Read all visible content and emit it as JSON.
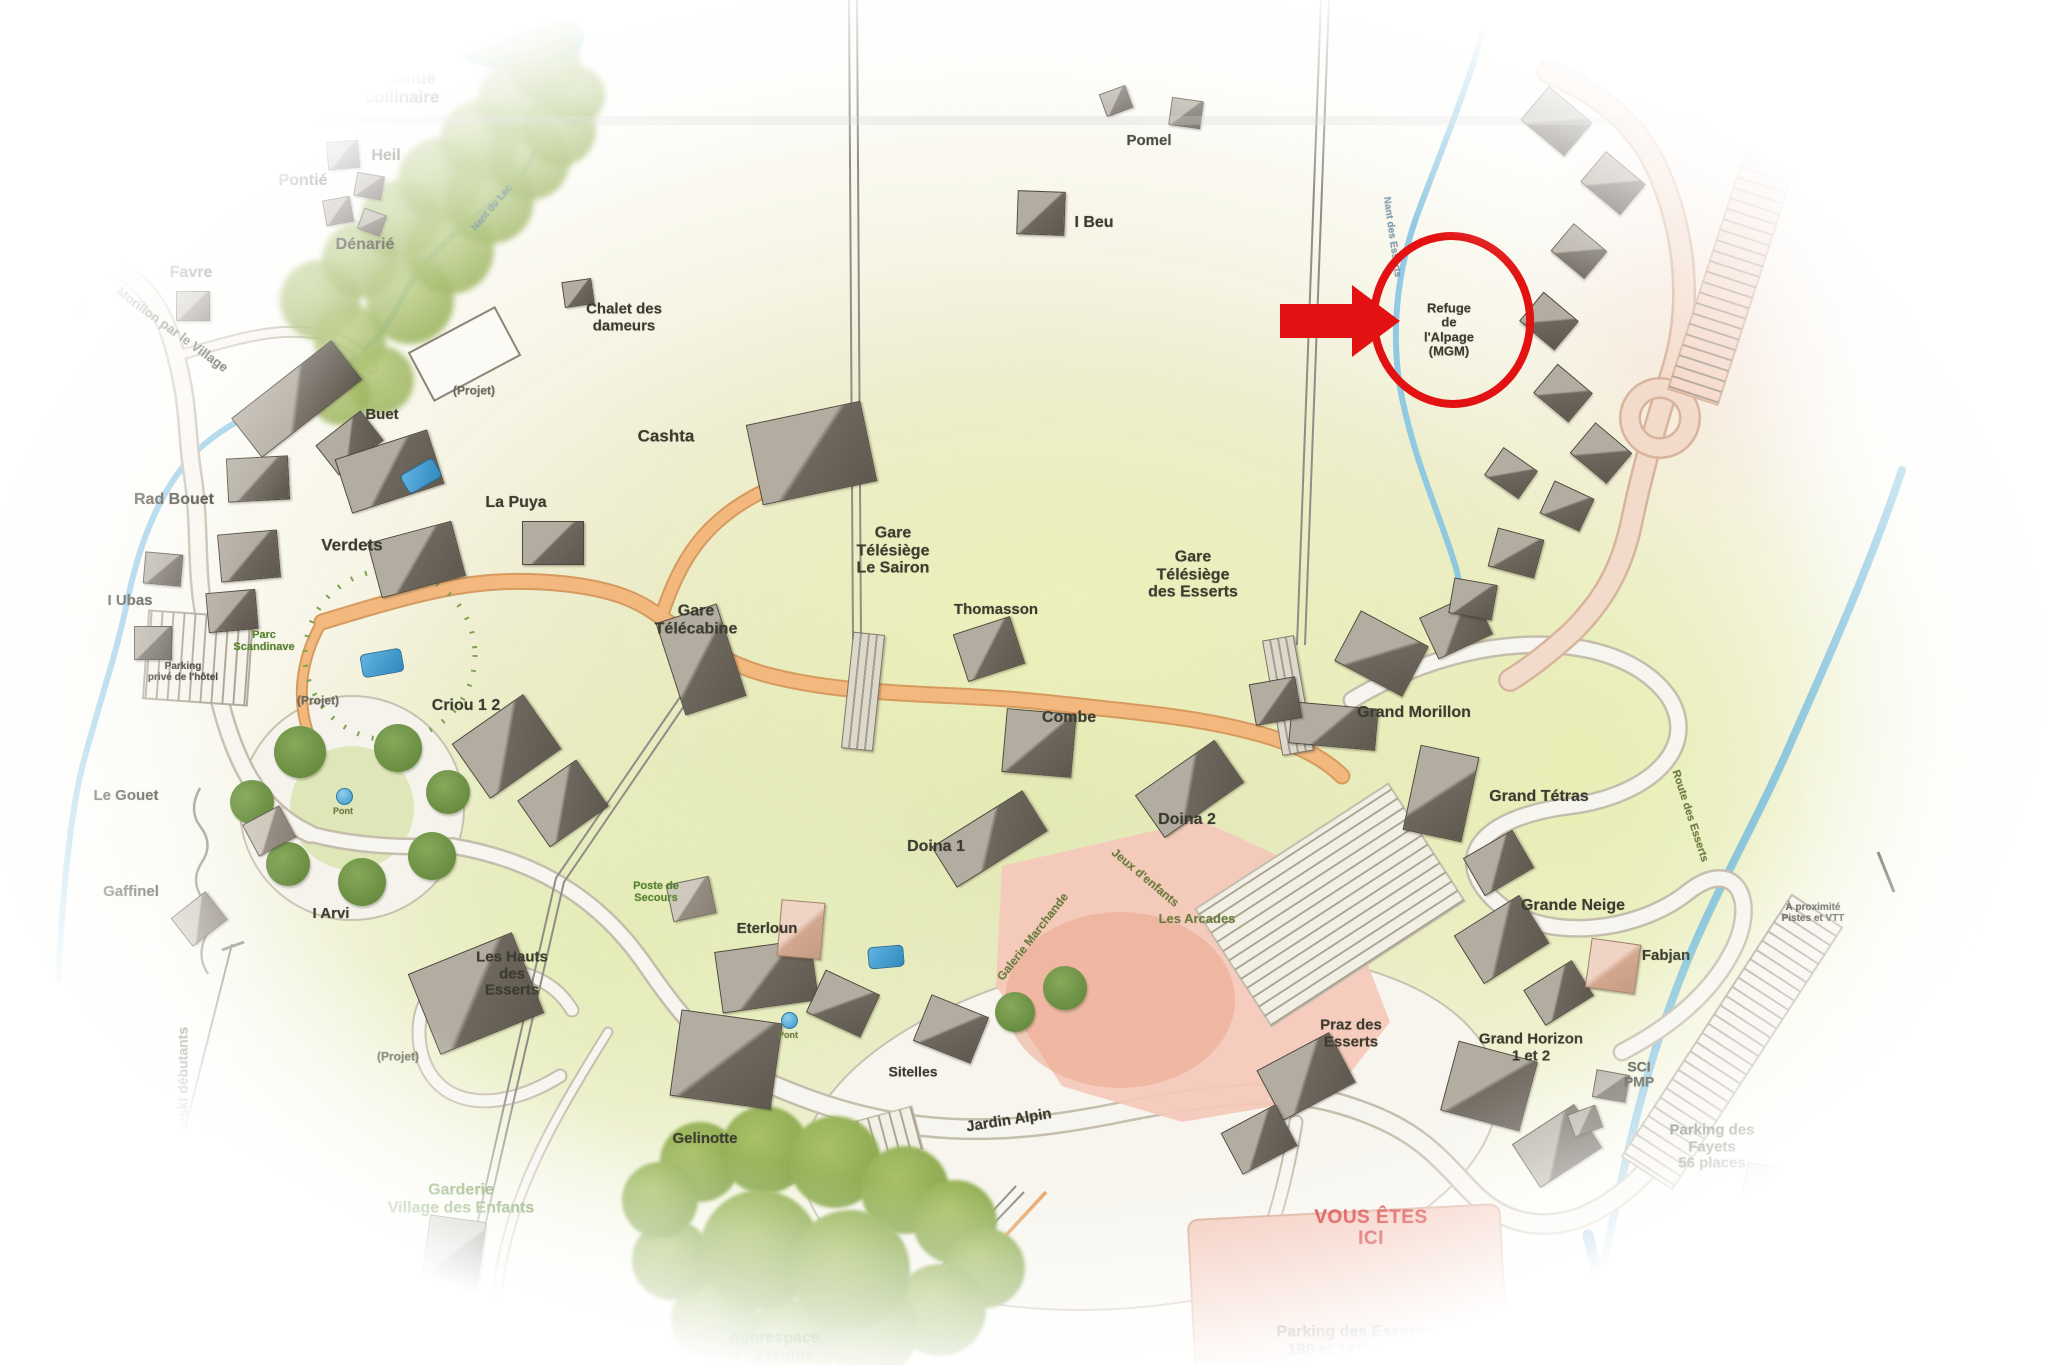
{
  "map": {
    "region_name": "Les Esserts",
    "annotation": {
      "highlight_label": "Refuge\nde\nl'Alpage\n(MGM)",
      "color": "#e21212"
    },
    "labels": [
      {
        "t": "Lac",
        "x": 438,
        "y": 46,
        "s": 17
      },
      {
        "t": "Retenue\ncollinaire",
        "x": 402,
        "y": 88,
        "s": 17
      },
      {
        "t": "Heil",
        "x": 386,
        "y": 156,
        "s": 16
      },
      {
        "t": "Pontié",
        "x": 303,
        "y": 181,
        "s": 16
      },
      {
        "t": "Dénarié",
        "x": 365,
        "y": 245,
        "s": 16
      },
      {
        "t": "Cochet",
        "x": 106,
        "y": 205,
        "s": 17
      },
      {
        "t": "Favre",
        "x": 191,
        "y": 273,
        "s": 16
      },
      {
        "t": "Chalet des\ndameurs",
        "x": 624,
        "y": 318,
        "s": 15
      },
      {
        "t": "Pomel",
        "x": 1149,
        "y": 141,
        "s": 15
      },
      {
        "t": "I Beu",
        "x": 1094,
        "y": 223,
        "s": 16
      },
      {
        "t": "Buet",
        "x": 382,
        "y": 415,
        "s": 15
      },
      {
        "t": "Cashta",
        "x": 666,
        "y": 437,
        "s": 17
      },
      {
        "t": "La Puya",
        "x": 516,
        "y": 503,
        "s": 16
      },
      {
        "t": "Verdets",
        "x": 352,
        "y": 546,
        "s": 17
      },
      {
        "t": "Gare\nTélécabine",
        "x": 696,
        "y": 620,
        "s": 16
      },
      {
        "t": "Gare\nTélésiège\nLe Sairon",
        "x": 893,
        "y": 551,
        "s": 16
      },
      {
        "t": "Thomasson",
        "x": 996,
        "y": 610,
        "s": 15
      },
      {
        "t": "Gare\nTélésiège\ndes Esserts",
        "x": 1193,
        "y": 575,
        "s": 16
      },
      {
        "t": "Combe",
        "x": 1069,
        "y": 718,
        "s": 16
      },
      {
        "t": "Grand Morillon",
        "x": 1414,
        "y": 713,
        "s": 16
      },
      {
        "t": "Grand Tétras",
        "x": 1539,
        "y": 797,
        "s": 16
      },
      {
        "t": "Grande Neige",
        "x": 1573,
        "y": 906,
        "s": 16
      },
      {
        "t": "Fabjan",
        "x": 1666,
        "y": 956,
        "s": 15
      },
      {
        "t": "Criou 1 2",
        "x": 466,
        "y": 706,
        "s": 16
      },
      {
        "t": "Rad Bouet",
        "x": 174,
        "y": 500,
        "s": 16
      },
      {
        "t": "I Ubas",
        "x": 130,
        "y": 601,
        "s": 15
      },
      {
        "t": "Le Gouet",
        "x": 126,
        "y": 796,
        "s": 15
      },
      {
        "t": "Gaffinel",
        "x": 131,
        "y": 892,
        "s": 15
      },
      {
        "t": "I Arvi",
        "x": 331,
        "y": 914,
        "s": 15
      },
      {
        "t": "Doina 1",
        "x": 936,
        "y": 847,
        "s": 16
      },
      {
        "t": "Doina 2",
        "x": 1187,
        "y": 820,
        "s": 16
      },
      {
        "t": "Eterloun",
        "x": 767,
        "y": 929,
        "s": 15
      },
      {
        "t": "Les Hauts\ndes\nEsserts",
        "x": 512,
        "y": 974,
        "s": 15
      },
      {
        "t": "Sitelles",
        "x": 913,
        "y": 1072,
        "s": 14
      },
      {
        "t": "Gelinotte",
        "x": 705,
        "y": 1139,
        "s": 15
      },
      {
        "t": "Jardin Alpin",
        "x": 1009,
        "y": 1121,
        "r": -9,
        "s": 15
      },
      {
        "t": "Praz des\nEsserts",
        "x": 1351,
        "y": 1034,
        "s": 15
      },
      {
        "t": "Grand Horizon\n1 et 2",
        "x": 1531,
        "y": 1048,
        "s": 15
      },
      {
        "t": "SCI\nPMP",
        "x": 1639,
        "y": 1075,
        "s": 14
      },
      {
        "t": "Parking des\nFayets\n56 places",
        "x": 1712,
        "y": 1147,
        "s": 15
      },
      {
        "t": "Parking des Esserts\n198 et 144 places",
        "x": 1353,
        "y": 1341,
        "s": 16
      },
      {
        "t": "Refuge\nde\nl'Alpage\n(MGM)",
        "x": 1449,
        "y": 330,
        "s": 13
      },
      {
        "t": "(Projet)",
        "x": 474,
        "y": 391,
        "s": 12,
        "c": "g2"
      },
      {
        "t": "(Projet)",
        "x": 318,
        "y": 701,
        "s": 12,
        "c": "g2"
      },
      {
        "t": "(Projet)",
        "x": 398,
        "y": 1057,
        "s": 12,
        "c": "g2"
      },
      {
        "t": "Les Arcades",
        "x": 1197,
        "y": 919,
        "s": 13,
        "c": "olv"
      },
      {
        "t": "Jeux d'enfants",
        "x": 1145,
        "y": 878,
        "r": 40,
        "s": 12,
        "c": "olv"
      },
      {
        "t": "Galerie Marchande",
        "x": 1033,
        "y": 937,
        "r": -52,
        "s": 12,
        "c": "olv"
      },
      {
        "t": "Parking\nprivé de l'hôtel",
        "x": 183,
        "y": 672,
        "s": 10
      },
      {
        "t": "Morillon par le Village",
        "x": 172,
        "y": 330,
        "r": 36,
        "s": 13
      },
      {
        "t": "Téléski débutants",
        "x": 183,
        "y": 1086,
        "r": -90,
        "s": 14
      },
      {
        "t": "VOUS ÊTES\nICI",
        "x": 1371,
        "y": 1229,
        "s": 19,
        "c": "red"
      },
      {
        "t": "Poste de\nSecours",
        "x": 656,
        "y": 892,
        "s": 11,
        "c": "grn"
      },
      {
        "t": "Parc\nScandinave",
        "x": 264,
        "y": 641,
        "s": 11,
        "c": "grn"
      },
      {
        "t": "Garderie\nVillage des Enfants",
        "x": 461,
        "y": 1199,
        "s": 16,
        "c": "grn"
      },
      {
        "t": "Jardin des\nNeiges",
        "x": 408,
        "y": 1324,
        "s": 11,
        "c": "grn"
      },
      {
        "t": "Agorespace\net 2 tennis",
        "x": 774,
        "y": 1347,
        "s": 16,
        "c": "grn"
      },
      {
        "t": "Route des Esserts",
        "x": 1690,
        "y": 816,
        "r": 72,
        "s": 11,
        "c": "olv"
      },
      {
        "t": "À proximité\nPistes et VTT",
        "x": 1813,
        "y": 913,
        "s": 10
      },
      {
        "t": "Abri Containers\ntri sélectif",
        "x": 1820,
        "y": 1184,
        "s": 10
      },
      {
        "t": "Itinéraire\n(Promenade, VTT, Raquettes)",
        "x": 1776,
        "y": 1336,
        "s": 10
      },
      {
        "t": "Pont",
        "x": 343,
        "y": 812,
        "s": 9,
        "c": "olv"
      },
      {
        "t": "Pont",
        "x": 788,
        "y": 1036,
        "s": 9,
        "c": "olv"
      },
      {
        "t": "Nant du Lac",
        "x": 492,
        "y": 208,
        "r": -50,
        "s": 10,
        "c": "fnt"
      },
      {
        "t": "Nant des Esserts",
        "x": 1392,
        "y": 237,
        "r": 82,
        "s": 10,
        "c": "fnt"
      }
    ],
    "buildings": [
      [
        342,
        154,
        30,
        26,
        -5,
        "d"
      ],
      [
        368,
        185,
        26,
        22,
        10,
        "d"
      ],
      [
        337,
        210,
        26,
        24,
        -10,
        "d"
      ],
      [
        371,
        221,
        22,
        20,
        20,
        "d"
      ],
      [
        118,
        232,
        36,
        26,
        -5,
        "d"
      ],
      [
        192,
        305,
        32,
        28,
        0,
        "d"
      ],
      [
        577,
        292,
        28,
        24,
        -8,
        "d"
      ],
      [
        1115,
        100,
        26,
        22,
        -20,
        "d"
      ],
      [
        1185,
        112,
        30,
        26,
        8,
        "d"
      ],
      [
        1040,
        212,
        46,
        42,
        2,
        "d"
      ],
      [
        295,
        398,
        125,
        48,
        -38,
        "d"
      ],
      [
        348,
        442,
        55,
        36,
        -38,
        "d"
      ],
      [
        462,
        352,
        95,
        52,
        -28,
        "l"
      ],
      [
        810,
        452,
        115,
        80,
        -12,
        "d"
      ],
      [
        552,
        542,
        60,
        42,
        0,
        "d"
      ],
      [
        388,
        470,
        95,
        55,
        -18,
        "d"
      ],
      [
        415,
        558,
        85,
        55,
        -15,
        "d"
      ],
      [
        257,
        478,
        60,
        42,
        -3,
        "d"
      ],
      [
        248,
        555,
        58,
        46,
        -5,
        "d"
      ],
      [
        231,
        610,
        48,
        38,
        -5,
        "d"
      ],
      [
        162,
        568,
        36,
        30,
        5,
        "d"
      ],
      [
        152,
        642,
        36,
        32,
        0,
        "d"
      ],
      [
        505,
        745,
        85,
        65,
        -35,
        "d"
      ],
      [
        562,
        802,
        70,
        55,
        -35,
        "d"
      ],
      [
        700,
        658,
        62,
        95,
        -18,
        "d"
      ],
      [
        988,
        648,
        58,
        48,
        -18,
        "d"
      ],
      [
        862,
        690,
        30,
        115,
        6,
        "h"
      ],
      [
        1287,
        694,
        30,
        115,
        -10,
        "h"
      ],
      [
        1038,
        742,
        68,
        62,
        5,
        "d"
      ],
      [
        988,
        838,
        105,
        46,
        -32,
        "d"
      ],
      [
        1188,
        788,
        95,
        50,
        -35,
        "d"
      ],
      [
        1380,
        652,
        75,
        55,
        28,
        "d"
      ],
      [
        1455,
        625,
        58,
        44,
        -25,
        "d"
      ],
      [
        1332,
        725,
        85,
        40,
        5,
        "d"
      ],
      [
        1274,
        700,
        45,
        40,
        -10,
        "d"
      ],
      [
        1555,
        120,
        55,
        42,
        40,
        "d"
      ],
      [
        1612,
        182,
        50,
        38,
        40,
        "d"
      ],
      [
        1578,
        250,
        42,
        34,
        40,
        "d"
      ],
      [
        1548,
        320,
        44,
        36,
        40,
        "d"
      ],
      [
        1562,
        392,
        44,
        36,
        40,
        "d"
      ],
      [
        1600,
        452,
        46,
        38,
        40,
        "d"
      ],
      [
        1566,
        505,
        42,
        34,
        25,
        "d"
      ],
      [
        1515,
        552,
        46,
        38,
        15,
        "d"
      ],
      [
        1472,
        598,
        42,
        34,
        10,
        "d"
      ],
      [
        1510,
        472,
        40,
        32,
        35,
        "d"
      ],
      [
        1440,
        792,
        58,
        85,
        12,
        "d"
      ],
      [
        1497,
        862,
        55,
        42,
        -30,
        "d"
      ],
      [
        1500,
        938,
        75,
        55,
        -32,
        "d"
      ],
      [
        1557,
        992,
        55,
        40,
        -32,
        "d"
      ],
      [
        1612,
        965,
        48,
        48,
        8,
        "p"
      ],
      [
        1488,
        1085,
        80,
        70,
        15,
        "d"
      ],
      [
        1556,
        1145,
        72,
        50,
        -33,
        "d"
      ],
      [
        1610,
        1085,
        32,
        26,
        10,
        "d"
      ],
      [
        1584,
        1120,
        28,
        22,
        -20,
        "d"
      ],
      [
        1305,
        1075,
        80,
        55,
        -28,
        "d"
      ],
      [
        1258,
        1138,
        60,
        45,
        -28,
        "d"
      ],
      [
        765,
        975,
        95,
        60,
        -8,
        "d"
      ],
      [
        842,
        1002,
        58,
        45,
        25,
        "d"
      ],
      [
        950,
        1028,
        60,
        48,
        22,
        "d"
      ],
      [
        725,
        1058,
        100,
        85,
        8,
        "d"
      ],
      [
        475,
        992,
        110,
        85,
        -22,
        "d"
      ],
      [
        690,
        898,
        42,
        36,
        -12,
        "g"
      ],
      [
        800,
        928,
        42,
        55,
        5,
        "p"
      ],
      [
        198,
        918,
        42,
        34,
        -38,
        "g"
      ],
      [
        268,
        830,
        40,
        34,
        -28,
        "g"
      ],
      [
        452,
        1252,
        55,
        68,
        8,
        "d"
      ],
      [
        392,
        1345,
        28,
        36,
        5,
        "p"
      ],
      [
        448,
        1332,
        20,
        28,
        5,
        "l"
      ],
      [
        1758,
        1182,
        28,
        36,
        10,
        "g"
      ]
    ],
    "trees": [
      [
        320,
        300,
        40,
        1
      ],
      [
        360,
        260,
        38,
        1
      ],
      [
        400,
        220,
        40,
        1
      ],
      [
        440,
        180,
        42,
        1
      ],
      [
        480,
        140,
        40,
        1
      ],
      [
        520,
        100,
        42,
        1
      ],
      [
        545,
        65,
        36,
        1
      ],
      [
        350,
        340,
        36,
        1
      ],
      [
        380,
        380,
        34,
        1
      ],
      [
        410,
        300,
        44,
        1
      ],
      [
        450,
        250,
        44,
        1
      ],
      [
        490,
        200,
        44,
        1
      ],
      [
        530,
        160,
        40,
        1
      ],
      [
        560,
        130,
        36,
        1
      ],
      [
        340,
        395,
        30,
        1
      ],
      [
        575,
        95,
        30,
        1
      ],
      [
        300,
        752,
        26,
        2
      ],
      [
        398,
        748,
        24,
        2
      ],
      [
        448,
        792,
        22,
        2
      ],
      [
        432,
        856,
        24,
        2
      ],
      [
        362,
        882,
        24,
        2
      ],
      [
        288,
        864,
        22,
        2
      ],
      [
        252,
        802,
        22,
        2
      ],
      [
        1065,
        988,
        22,
        2
      ],
      [
        1015,
        1012,
        20,
        2
      ],
      [
        700,
        1162,
        40,
        3
      ],
      [
        765,
        1150,
        44,
        3
      ],
      [
        835,
        1162,
        46,
        3
      ],
      [
        905,
        1190,
        44,
        3
      ],
      [
        955,
        1222,
        42,
        3
      ],
      [
        985,
        1268,
        40,
        3
      ],
      [
        940,
        1310,
        46,
        3
      ],
      [
        870,
        1330,
        48,
        3
      ],
      [
        790,
        1345,
        46,
        3
      ],
      [
        715,
        1320,
        44,
        3
      ],
      [
        672,
        1260,
        40,
        3
      ],
      [
        660,
        1200,
        38,
        3
      ],
      [
        760,
        1250,
        60,
        3
      ],
      [
        850,
        1270,
        60,
        3
      ]
    ],
    "pools": [
      [
        420,
        475,
        36,
        20,
        -30
      ],
      [
        381,
        662,
        40,
        22,
        -10
      ],
      [
        885,
        956,
        34,
        20,
        -5
      ]
    ],
    "fountains": [
      [
        343,
        795
      ],
      [
        788,
        1019
      ]
    ]
  }
}
